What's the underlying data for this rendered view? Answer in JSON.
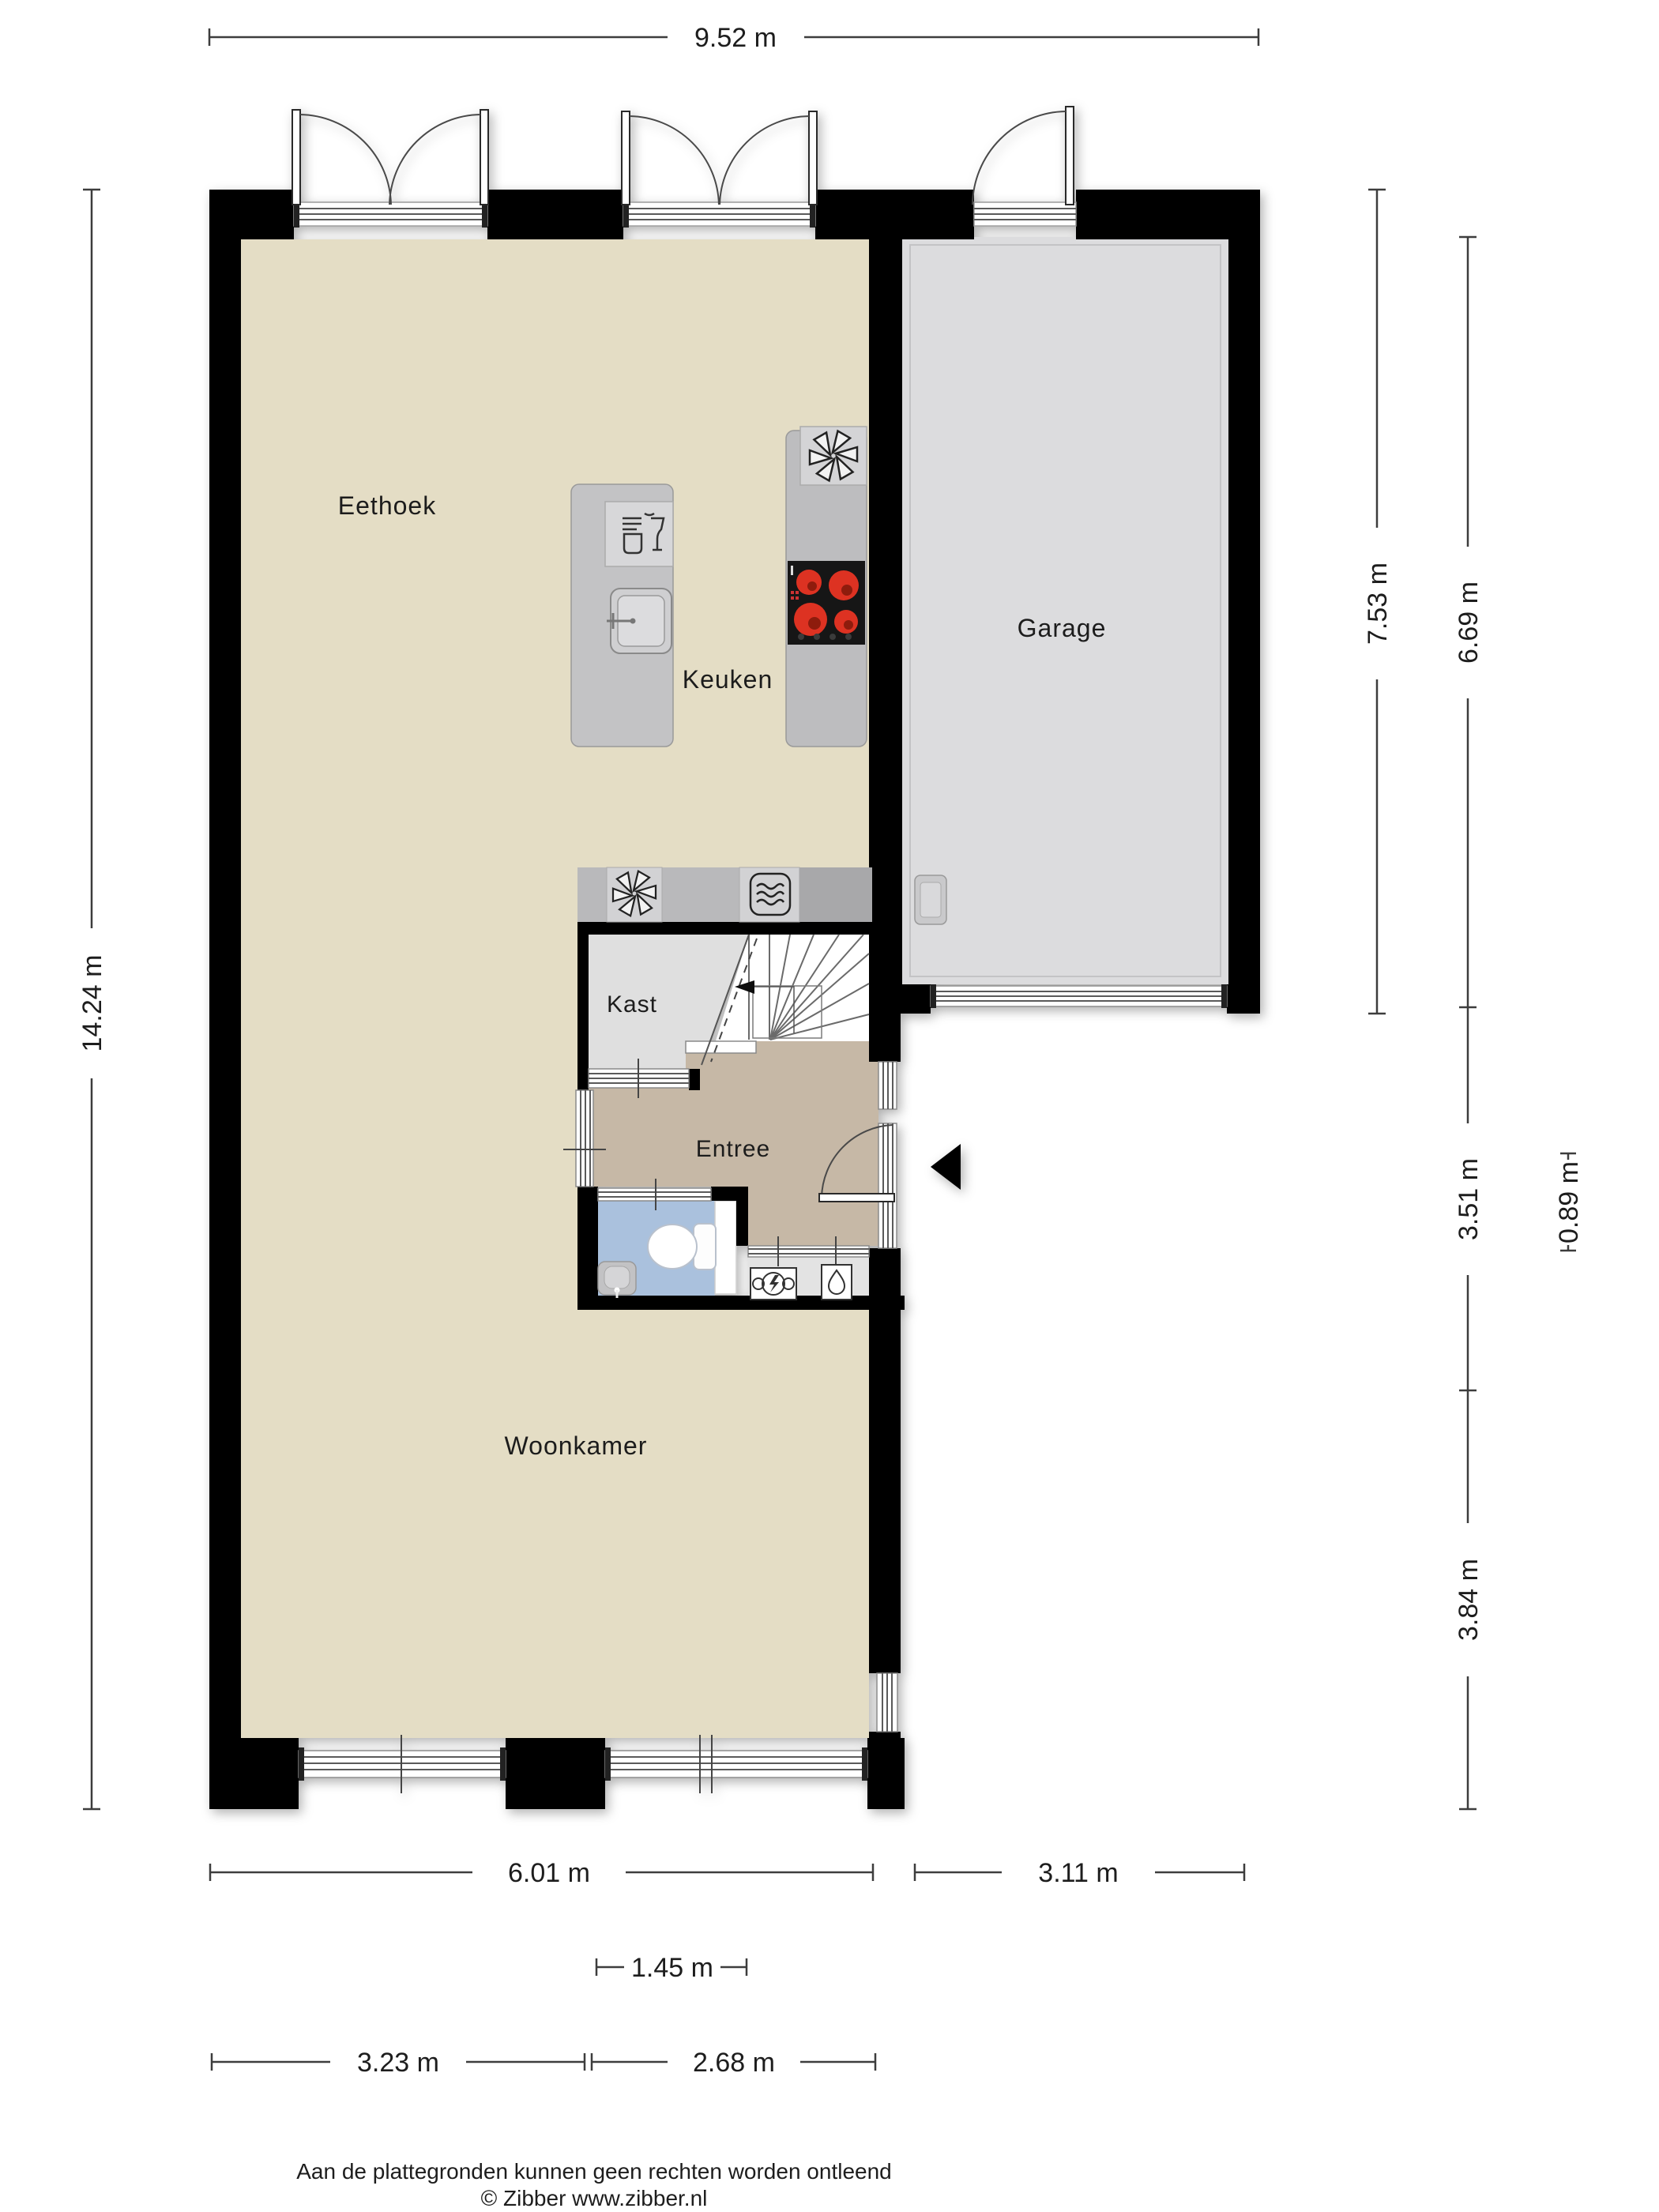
{
  "title": "Plattegrond begane grond",
  "rooms": {
    "eethoek": "Eethoek",
    "keuken": "Keuken",
    "garage": "Garage",
    "kast": "Kast",
    "entree": "Entree",
    "woonkamer": "Woonkamer"
  },
  "dims": {
    "total_width": "9.52 m",
    "total_height": "14.24 m",
    "garage_outer": "7.53 m",
    "garage_inner": "6.69 m",
    "hall_section": "3.51 m",
    "meter_section": "0.89 m",
    "living_lower": "3.84 m",
    "living_width": "6.01 m",
    "garage_width": "3.11 m",
    "kitchen_island": "1.45 m",
    "window_left": "3.23 m",
    "window_right": "2.68 m"
  },
  "footer": {
    "disclaimer": "Aan de plattegronden kunnen geen rechten worden ontleend",
    "copyright": "© Zibber www.zibber.nl"
  },
  "icons": [
    "extractor-fan-icon",
    "microwave-icon",
    "dishwasher-icon",
    "sink-icon",
    "stove-icon",
    "toilet-icon",
    "hand-basin-icon",
    "electricity-meter-icon",
    "water-meter-icon",
    "boiler-icon",
    "entrance-arrow-icon",
    "stairs-arrow-icon"
  ],
  "colors": {
    "wall": "#000000",
    "floor_living": "#e4ddc5",
    "floor_garage": "#dcdcde",
    "floor_entree": "#c6b8a6",
    "floor_toilet": "#aac1dd",
    "floor_kast": "#dfdfdf",
    "floor_meterkast": "#e3e3e3",
    "counter": "#bcbcbe",
    "counter_light": "#d3d3d5",
    "counter_dark": "#a9a9ab",
    "stove": "#161616",
    "burner": "#dd3322",
    "dimension": "#3d3d3d"
  }
}
